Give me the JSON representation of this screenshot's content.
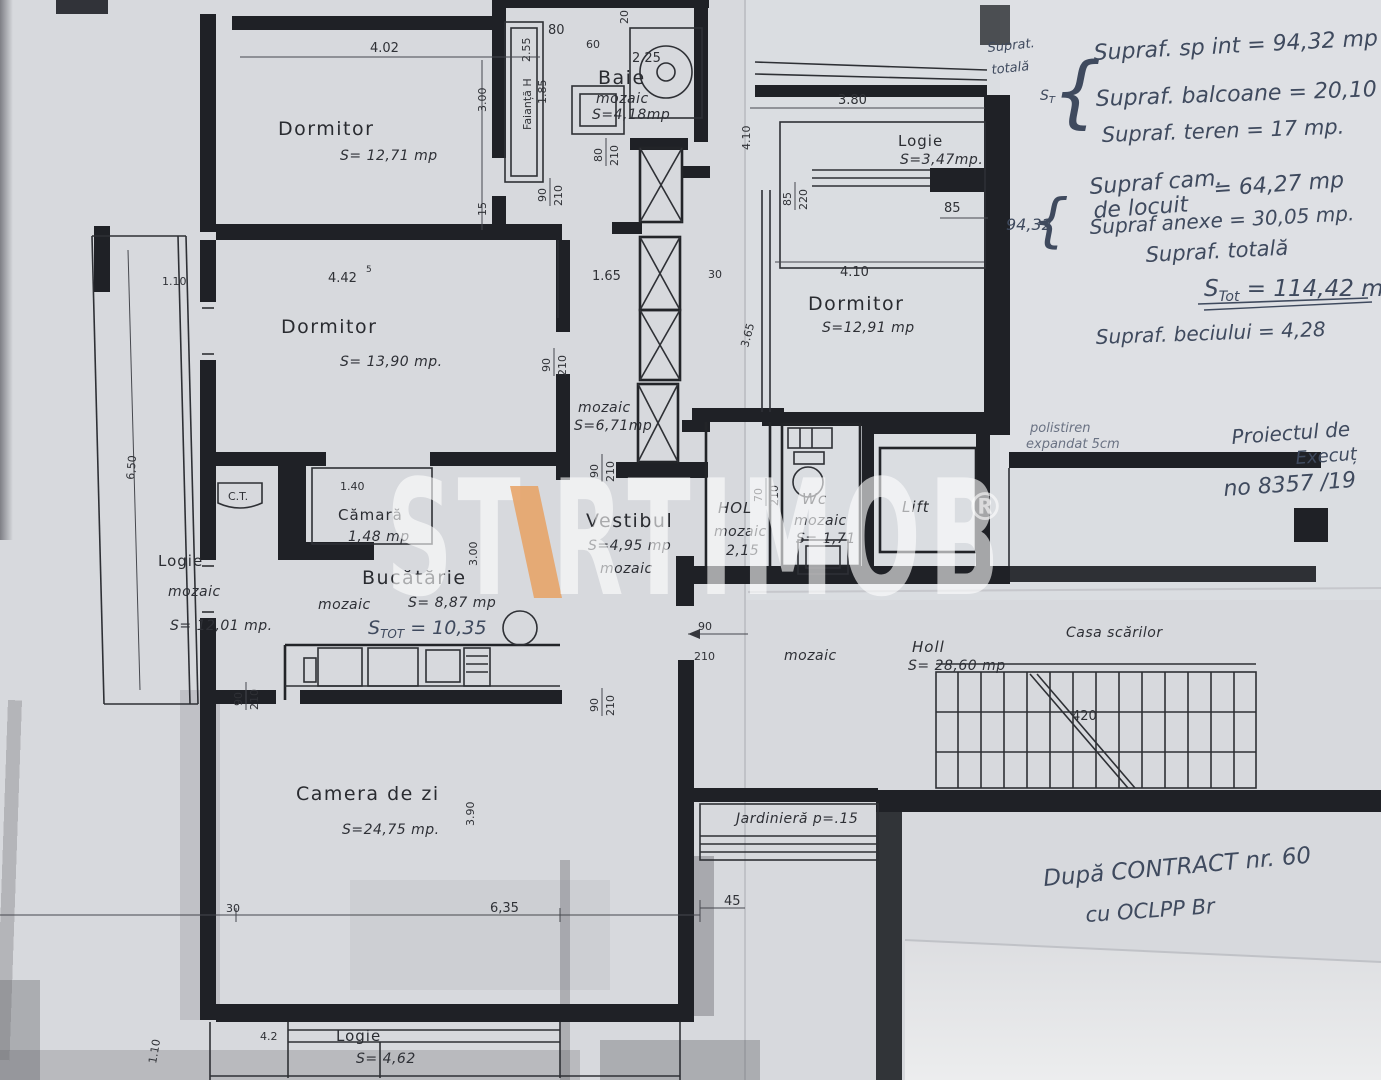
{
  "paper": {
    "bg": "#d7d9dd",
    "ink": "#25272c",
    "pen": "#3f4a5e",
    "accent": "#e8a163"
  },
  "watermark": {
    "left": "ST",
    "right": "RTIMOB",
    "reg": "®"
  },
  "rooms": {
    "dormitor1": {
      "name": "Dormitor",
      "area": "S= 12,71 mp"
    },
    "dormitor2": {
      "name": "Dormitor",
      "area": "S= 13,90 mp."
    },
    "dormitor3": {
      "name": "Dormitor",
      "area": "S=12,91 mp"
    },
    "baie": {
      "name": "Baie",
      "finish": "mozaic",
      "area": "S=4,18mp"
    },
    "camara": {
      "name": "Cămară",
      "area": "1,48 mp"
    },
    "bucatarie": {
      "name": "Bucătărie",
      "finish": "mozaic",
      "area": "S= 8,87 mp",
      "total": {
        "s": "S",
        "sub": "TOT",
        "val": " = 10,35"
      }
    },
    "logie_left": {
      "name": "Logie",
      "finish": "mozaic",
      "area": "S= 12,01 mp."
    },
    "logie_right": {
      "name": "Logie",
      "area": "S=3,47mp."
    },
    "logie_bottom": {
      "name": "Logie",
      "area": "S= 4,62"
    },
    "vestibul": {
      "name": "Vestibul",
      "area": "S=4,95 mp",
      "finish": "mozaic"
    },
    "hall_mozaic": {
      "finish": "mozaic",
      "area": "S=6,71mp"
    },
    "hol": {
      "name": "HOL",
      "finish": "mozaic",
      "dim": "2,15"
    },
    "wc": {
      "name": "Wc",
      "finish": "mozaic",
      "area": "S= 1,71"
    },
    "lift": {
      "name": "Lift"
    },
    "camera_zi": {
      "name": "Camera de zi",
      "area": "S=24,75 mp."
    },
    "holl": {
      "name": "Holl",
      "area": "S= 28,60 mp"
    },
    "casa_scarilor": {
      "name": "Casa scărilor"
    },
    "corridor": {
      "finish": "mozaic"
    },
    "jardiniera": {
      "label": "Jardinieră p=.15"
    },
    "ct": {
      "label": "C.T."
    }
  },
  "dims": {
    "d402": "4.02",
    "d300": "3.00",
    "d15": "15",
    "d442": "4.42",
    "sup5": "5",
    "d90": "90",
    "d210": "210",
    "d80": "80",
    "d60": "60",
    "d20": "20",
    "d225": "2.25",
    "d255": "2.55",
    "d185": "1.85",
    "faianta": "Faianță H",
    "d165": "1.65",
    "d30": "30",
    "d365": "3.65",
    "d85": "85",
    "d220": "220",
    "d380": "3.80",
    "d410": "4.10",
    "d650": "6,50",
    "d110": "1.10",
    "d140": "1.40",
    "d70": "70",
    "d390": "3.90",
    "d635": "6,35",
    "d45": "45",
    "d42": "4.2",
    "d420": "420"
  },
  "notes": {
    "supr_label_1": "Suprat.",
    "supr_label_2": "totală",
    "brace": "{",
    "st_brace": {
      "s": "S",
      "sub": "T"
    },
    "sp_int": "Supraf. sp int = 94,32 mp",
    "balcoane": "Supraf. balcoane = 20,10 mp",
    "teren": "Supraf. teren = 17 mp.",
    "cam_locuit_1": "Supraf cam.",
    "cam_locuit_2": "de locuit",
    "cam_locuit_val": "= 64,27 mp",
    "brace_val": "94,32",
    "anexe": "Supraf anexe = 30,05 mp.",
    "totala_label": "Supraf. totală",
    "stot": {
      "s": "S",
      "sub": "Tot",
      "val": " = 114,42 m"
    },
    "beci": "Supraf. beciului = 4,28",
    "polistiren_1": "polistiren",
    "polistiren_2": "expandat 5cm",
    "proiect_1": "Proiectul de",
    "proiect_2": "Execuț",
    "proiect_3": "no 8357 /19",
    "contract_1": "După CONTRACT nr. 60",
    "contract_2": "cu OCLPP Br"
  }
}
